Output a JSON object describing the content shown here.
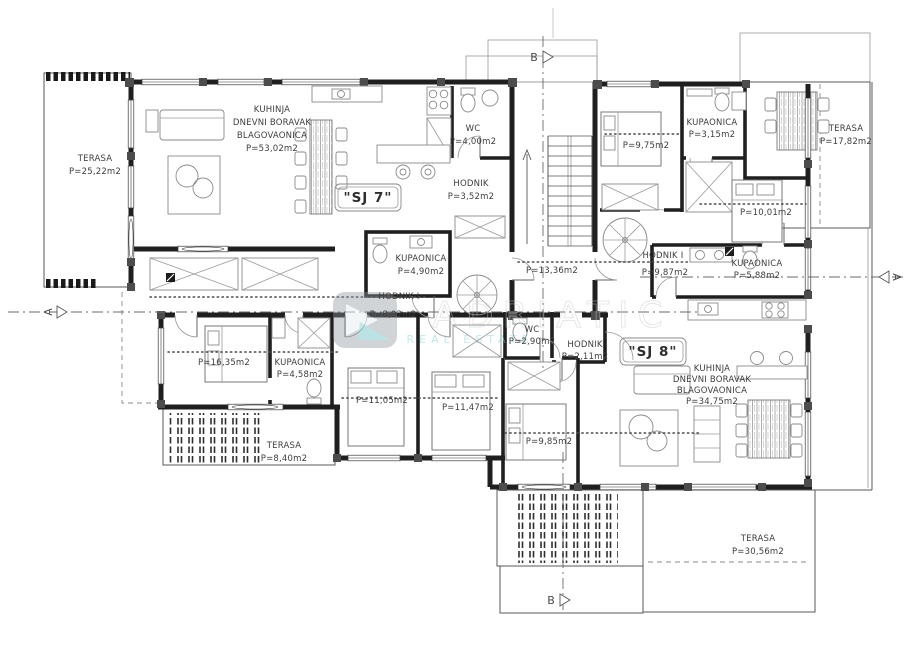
{
  "document": {
    "type": "apartment-floor-plan",
    "background": "#ffffff",
    "line_color": "#1f1f1f"
  },
  "watermark": {
    "brand": "ADRIATIC",
    "tagline": "REAL ESTATE",
    "accent_color": "#79cfd3"
  },
  "section_markers": {
    "a_left": "A",
    "a_right": "A",
    "b_top": "B",
    "b_bottom": "B"
  },
  "stairwell": {
    "area": "P=13,36m2"
  },
  "units": {
    "sj7": {
      "tag": "\"SJ 7\"",
      "rooms": {
        "terrace_nw": {
          "name": "TERASA",
          "area": "P=25,22m2"
        },
        "living": {
          "name_line1": "KUHINJA",
          "name_line2": "DNEVNI BORAVAK",
          "name_line3": "BLAGOVAONICA",
          "area": "P=53,02m2"
        },
        "wc": {
          "name": "WC",
          "area": "P=4,00m2"
        },
        "hallway": {
          "name": "HODNIK",
          "area": "P=3,52m2"
        },
        "bathroom": {
          "name": "KUPAONICA",
          "area": "P=4,90m2"
        },
        "hallway_i": {
          "name": "HODNIK I",
          "area": "P=8,02m2"
        },
        "bedroom_1": {
          "area": "P=16,35m2"
        },
        "bathroom_2": {
          "name": "KUPAONICA",
          "area": "P=4,58m2"
        },
        "bedroom_2": {
          "area": "P=11,05m2"
        },
        "bedroom_3": {
          "area": "P=11,47m2"
        },
        "terrace_sw": {
          "name": "TERASA",
          "area": "P=8,40m2"
        }
      }
    },
    "sj8": {
      "tag": "\"SJ 8\"",
      "rooms": {
        "bedroom_1": {
          "area": "P=9,75m2"
        },
        "bathroom_1": {
          "name": "KUPAONICA",
          "area": "P=3,15m2"
        },
        "terrace_ne": {
          "name": "TERASA",
          "area": "P=17,82m2"
        },
        "bedroom_2": {
          "area": "P=10,01m2"
        },
        "hallway_i": {
          "name": "HODNIK I",
          "area": "P=9,87m2"
        },
        "bathroom_2": {
          "name": "KUPAONICA",
          "area": "P=5,88m2"
        },
        "wc": {
          "name": "WC",
          "area": "P=2,90m2"
        },
        "hallway": {
          "name": "HODNIK",
          "area": "P=2,11m2"
        },
        "living": {
          "name_line1": "KUHINJA",
          "name_line2": "DNEVNI BORAVAK",
          "name_line3": "BLAGOVAONICA",
          "area": "P=34,75m2"
        },
        "bedroom_3": {
          "area": "P=9,85m2"
        },
        "terrace_s": {
          "name": "TERASA",
          "area": "P=30,56m2"
        }
      }
    }
  }
}
